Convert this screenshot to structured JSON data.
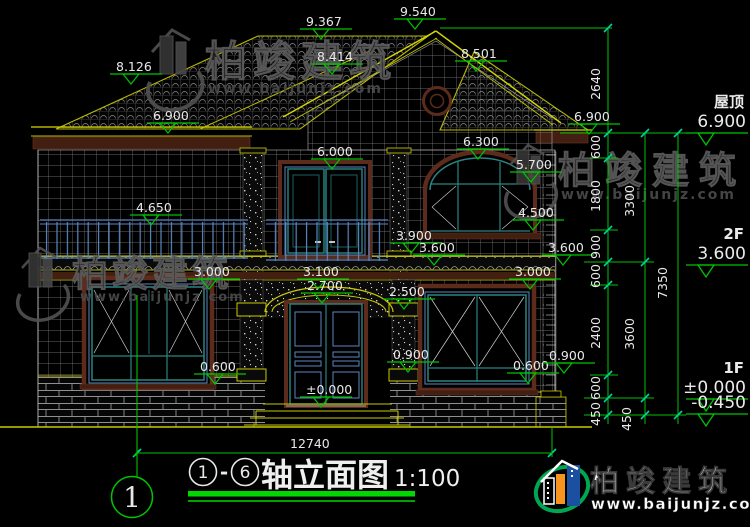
{
  "title": {
    "axis_start": "1",
    "axis_end": "6",
    "separator": "-",
    "name": "轴立面图",
    "scale": "1:100"
  },
  "axis_bubble": "1",
  "overall_width_dim": "12740",
  "watermark": {
    "name": "柏竣建筑",
    "url": "www.baijunjz.com"
  },
  "logo": {
    "name": "柏竣建筑",
    "url": "www.baijunjz.com"
  },
  "colors": {
    "dim_green": "#00c400",
    "cad_yellow": "#b9b900",
    "frame_teal": "#2a8583",
    "trim_maroon": "#5d2b1b",
    "rail_blue": "#5b86c0",
    "logo_green": "#00a651",
    "logo_blue": "#1b4fa0",
    "logo_orange": "#f7941d"
  },
  "elevation_markers": [
    {
      "label": "9.367",
      "x": 306,
      "y": 26
    },
    {
      "label": "9.540",
      "x": 400,
      "y": 16
    },
    {
      "label": "8.501",
      "x": 461,
      "y": 58
    },
    {
      "label": "8.126",
      "x": 116,
      "y": 71
    },
    {
      "label": "8.414",
      "x": 317,
      "y": 61
    },
    {
      "label": "6.900",
      "x": 153,
      "y": 120
    },
    {
      "label": "6.900",
      "x": 574,
      "y": 121
    },
    {
      "label": "6.000",
      "x": 317,
      "y": 156
    },
    {
      "label": "6.300",
      "x": 463,
      "y": 146
    },
    {
      "label": "5.700",
      "x": 516,
      "y": 169
    },
    {
      "label": "4.650",
      "x": 136,
      "y": 212
    },
    {
      "label": "4.500",
      "x": 518,
      "y": 217
    },
    {
      "label": "3.900",
      "x": 396,
      "y": 240
    },
    {
      "label": "3.600",
      "x": 419,
      "y": 252
    },
    {
      "label": "3.600",
      "x": 548,
      "y": 252
    },
    {
      "label": "3.000",
      "x": 194,
      "y": 276
    },
    {
      "label": "3.100",
      "x": 303,
      "y": 276
    },
    {
      "label": "2.700",
      "x": 307,
      "y": 290
    },
    {
      "label": "3.000",
      "x": 515,
      "y": 276
    },
    {
      "label": "2.500",
      "x": 389,
      "y": 296
    },
    {
      "label": "0.900",
      "x": 393,
      "y": 359
    },
    {
      "label": "0.600",
      "x": 200,
      "y": 371
    },
    {
      "label": "0.600",
      "x": 513,
      "y": 370
    },
    {
      "label": "0.900",
      "x": 549,
      "y": 360
    },
    {
      "label": "±0.000",
      "x": 306,
      "y": 394
    }
  ],
  "chain_dims": [
    {
      "label": "2640",
      "x": 600,
      "y": 84
    },
    {
      "label": "600",
      "x": 600,
      "y": 147
    },
    {
      "label": "1800",
      "x": 600,
      "y": 196
    },
    {
      "label": "900",
      "x": 600,
      "y": 247
    },
    {
      "label": "600",
      "x": 600,
      "y": 276
    },
    {
      "label": "2400",
      "x": 600,
      "y": 333
    },
    {
      "label": "600",
      "x": 600,
      "y": 388
    },
    {
      "label": "450",
      "x": 600,
      "y": 414
    },
    {
      "label": "3300",
      "x": 634,
      "y": 201
    },
    {
      "label": "3600",
      "x": 634,
      "y": 334
    },
    {
      "label": "450",
      "x": 631,
      "y": 419
    },
    {
      "label": "7350",
      "x": 667,
      "y": 283
    }
  ],
  "levels_right": [
    {
      "floor": "屋顶",
      "value": "6.900",
      "line_y": 133
    },
    {
      "floor": "2F",
      "value": "3.600",
      "line_y": 265
    },
    {
      "floor": "1F",
      "value": "±0.000",
      "line_y": 399
    },
    {
      "floor": "",
      "value": "-0.450",
      "line_y": 414
    }
  ]
}
